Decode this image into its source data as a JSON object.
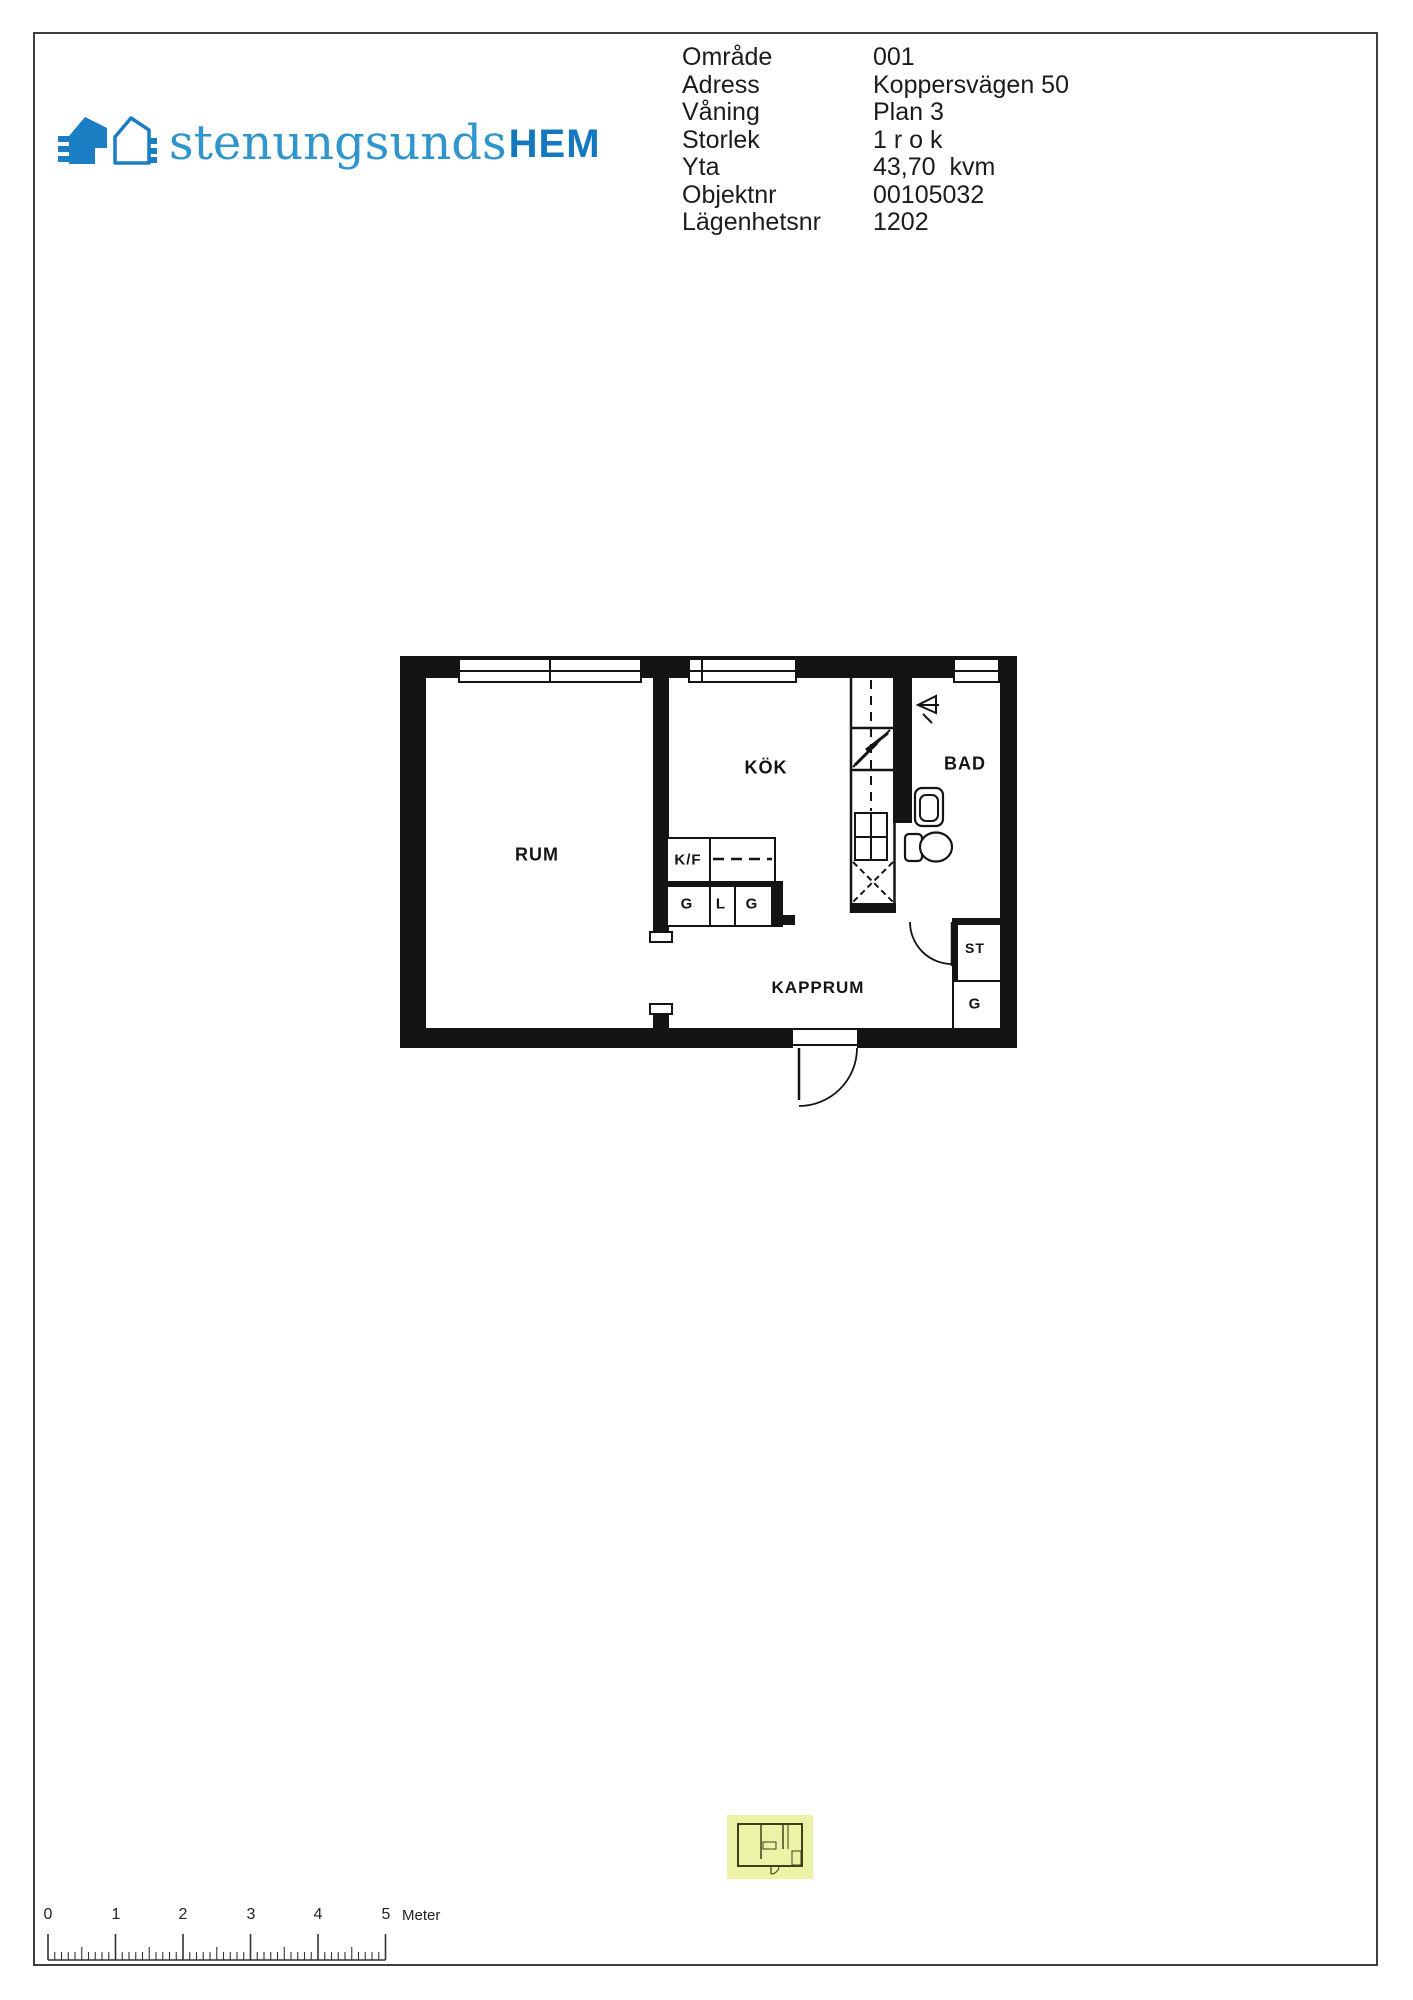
{
  "logo": {
    "text_light": "stenungsunds",
    "text_bold": "HEM",
    "color_light": "#2F95CD",
    "color_dark": "#1478BE"
  },
  "info": {
    "rows": [
      {
        "label": "Område",
        "value": "001"
      },
      {
        "label": "Adress",
        "value": "Koppersvägen 50"
      },
      {
        "label": "Våning",
        "value": "Plan 3"
      },
      {
        "label": "Storlek",
        "value": "1 r o k"
      },
      {
        "label": "Yta",
        "value": "43,70  kvm"
      },
      {
        "label": "Objektnr",
        "value": "00105032"
      },
      {
        "label": "Lägenhetsnr",
        "value": "1202"
      }
    ]
  },
  "plan": {
    "labels": {
      "rum": "RUM",
      "kok": "KÖK",
      "bad": "BAD",
      "kapprum": "KAPPRUM",
      "kf": "K/F",
      "g1": "G",
      "l": "L",
      "g2": "G",
      "st": "ST",
      "g3": "G"
    },
    "wall_color": "#141414"
  },
  "thumbnail": {
    "highlight_color": "#ECF3A7"
  },
  "scale_bar": {
    "ticks": [
      "0",
      "1",
      "2",
      "3",
      "4",
      "5"
    ],
    "unit": "Meter"
  }
}
